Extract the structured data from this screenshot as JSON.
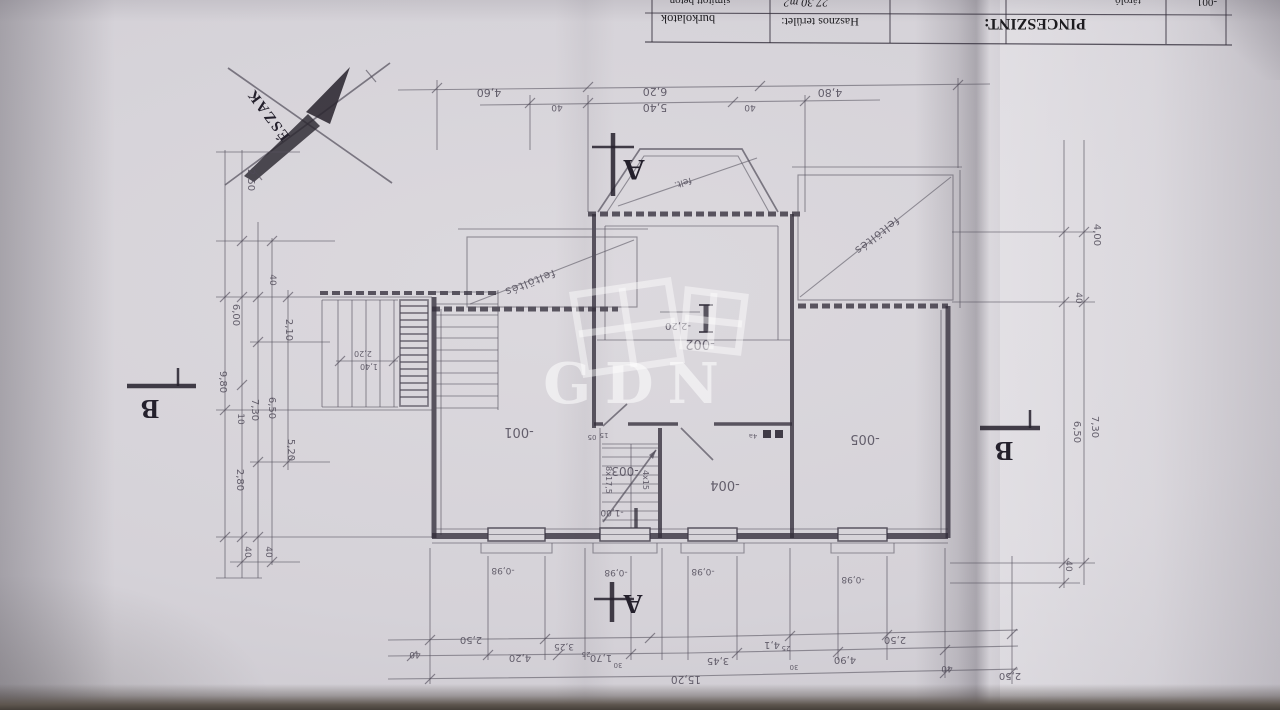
{
  "title_block": {
    "title": "PINCESZINT:",
    "area_header": "Hasznos terület:",
    "finishes_header": "burkolatok",
    "room_number": "-001",
    "room_name": "tároló",
    "room_area": "27,30 m2",
    "room_finish": "simított beton"
  },
  "compass": {
    "north_label": "ÉSZAK"
  },
  "watermark": {
    "text": "GDN"
  },
  "section_marks": {
    "a": "A",
    "b": "B"
  },
  "rooms": {
    "r001": "-001",
    "r002": "-002",
    "r003": "-003",
    "r004": "-004",
    "r005": "-005"
  },
  "levels": {
    "basement": "-2,20",
    "stair_landing": "-1,00"
  },
  "fill_areas": {
    "fill_a": "feltöltés",
    "fill_b": "feltöltés",
    "fill_small": "felt."
  },
  "stairs": {
    "note_a": "8x17,5",
    "note_b": "4x15",
    "note_c": "05",
    "note_d": "15",
    "dim_a": "2,20",
    "dim_b": "1,40"
  },
  "windows": {
    "sill_label": "-0,98"
  },
  "annotations": {
    "beam_mark": "4a"
  },
  "dims": {
    "top": [
      "4,60",
      "40",
      "6,20",
      "5,40",
      "40",
      "4,80"
    ],
    "left": [
      "2,50",
      "40",
      "6,00",
      "2,10",
      "9,80",
      "10",
      "7,30",
      "6,50",
      "5,20",
      "2,80",
      "40",
      "40"
    ],
    "right": [
      "4,00",
      "40",
      "7,30",
      "6,50",
      "40"
    ],
    "bottom": [
      "2,50",
      "3,25",
      "25",
      "1,70",
      "30",
      "40",
      "4,20",
      "15,20",
      "3,45",
      "4,1",
      "25",
      "4,90",
      "30",
      "2,50",
      "40",
      "2,50"
    ]
  },
  "colors": {
    "pencil": "#4f4a58",
    "ink": "#1c1b1f",
    "paper": "#d7d4d9",
    "wall": "#2f2b36",
    "watermark": "#ffffff"
  }
}
